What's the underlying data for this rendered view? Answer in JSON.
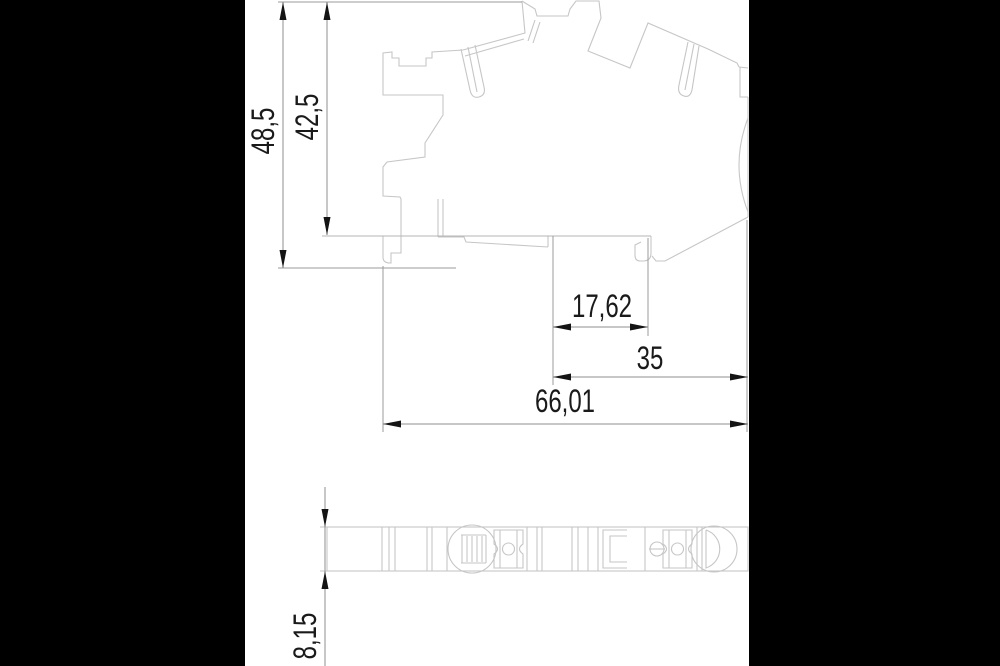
{
  "drawing": {
    "kind": "technical-dimension-drawing",
    "views": {
      "side_view": "terminal-block-profile",
      "bottom_view": "terminal-block-footprint"
    },
    "dimensions": {
      "overall_height": "48,5",
      "upper_height": "42,5",
      "inner_width": "17,62",
      "rail_width": "35",
      "overall_width": "66,01",
      "profile_depth": "8,15"
    },
    "colors": {
      "letterbox": "#000000",
      "paper": "#ffffff",
      "outline": "#c6c6c6",
      "dimension_line": "#8f8f8f",
      "annotation": "#1a1a1a"
    }
  }
}
